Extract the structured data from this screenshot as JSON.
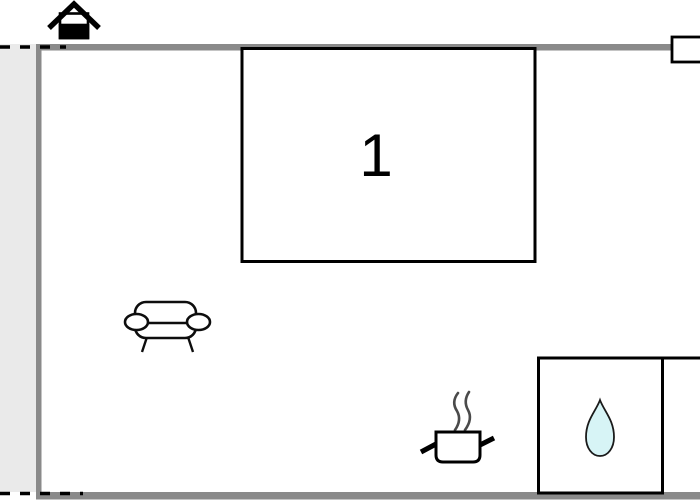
{
  "floorplan": {
    "room_label": "1",
    "icons": {
      "entrance": "house-icon",
      "living_area": "sofa-icon",
      "kitchen": "cooking-pot-icon",
      "bathroom": "water-drop-icon"
    },
    "colors": {
      "wall": "#8a8a8a",
      "terrace": "#eaeaea",
      "water_drop_fill": "#d7f4f6",
      "outline": "#000000",
      "background": "#ffffff"
    }
  }
}
